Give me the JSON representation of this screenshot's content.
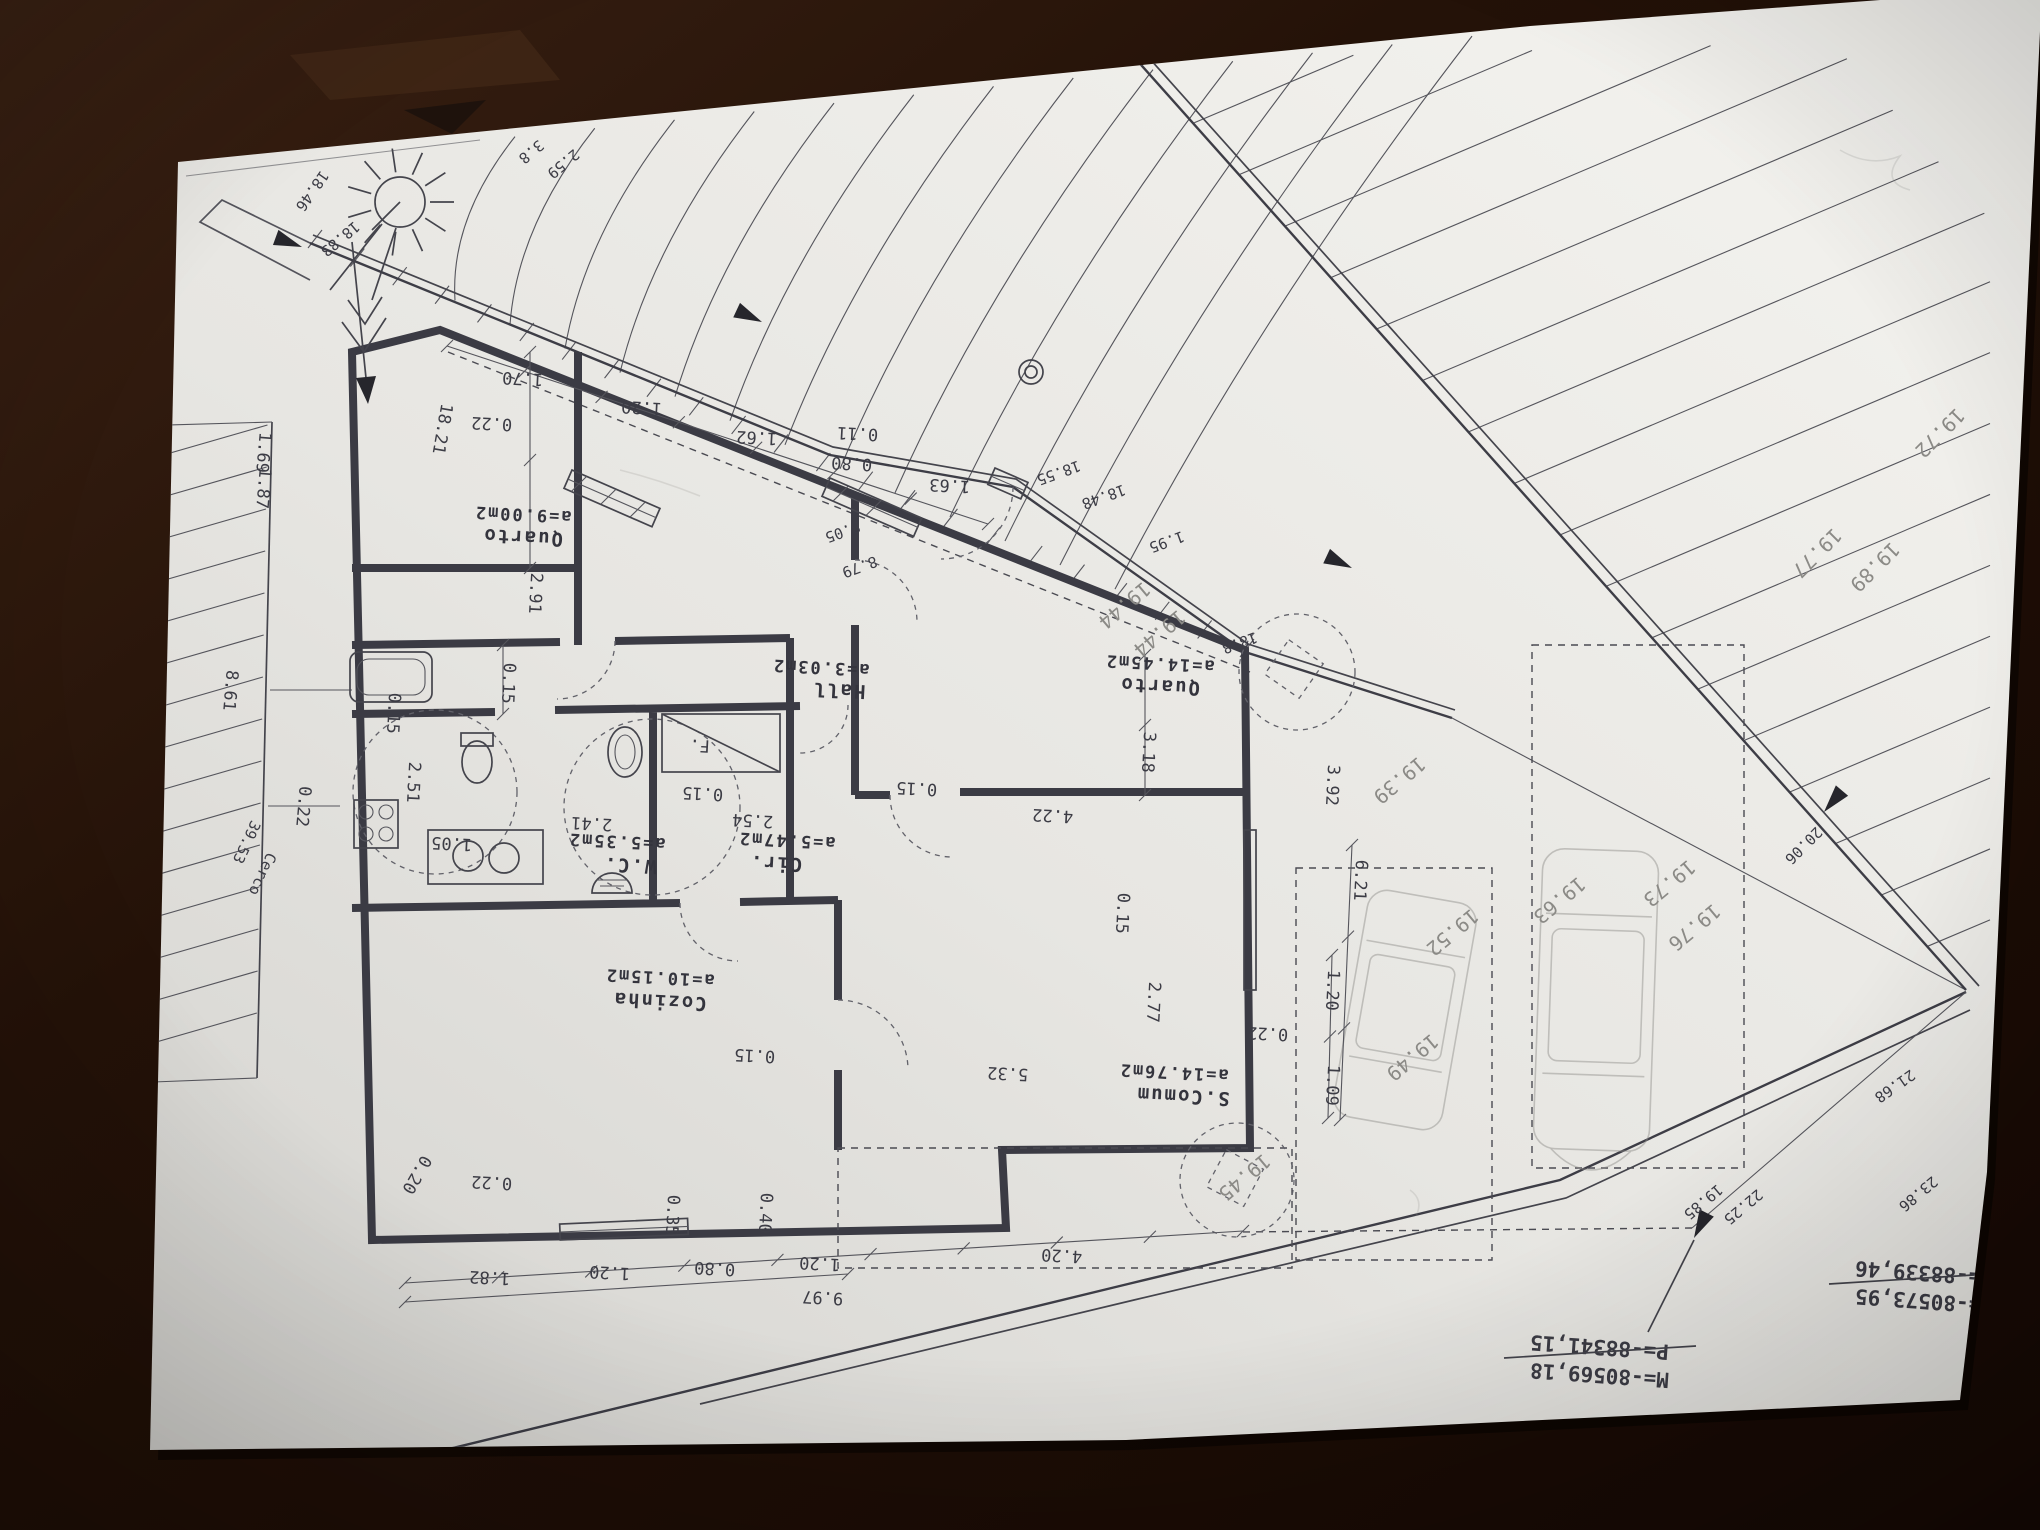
{
  "scene": {
    "description": "Photograph of an architectural site/floor plan sheet lying rotated 180 degrees on a dark wooden table",
    "table_color": "#221308",
    "paper_color": "#e9e8e4",
    "ink_color": "#3c3c45",
    "pencil_color": "#8b8a86"
  },
  "plan": {
    "rooms": [
      {
        "name": "Quarto",
        "area": "a=9.00m2",
        "nx": 523,
        "ny": 531,
        "ax": 523,
        "ay": 509
      },
      {
        "name": "Hall",
        "area": "a=3.03m2",
        "nx": 839,
        "ny": 684,
        "ax": 821,
        "ay": 662
      },
      {
        "name": "Quarto",
        "area": "a=14.45m2",
        "nx": 1160,
        "ny": 680,
        "ax": 1160,
        "ay": 658
      },
      {
        "name": "W.C.",
        "area": "a=5.35m2",
        "nx": 630,
        "ny": 859,
        "ax": 617,
        "ay": 836
      },
      {
        "name": "Cir.",
        "area": "a=5.47m2",
        "nx": 776,
        "ny": 857,
        "ax": 787,
        "ay": 835
      },
      {
        "name": "Cozinha",
        "area": "a=10.15m2",
        "nx": 660,
        "ny": 995,
        "ax": 660,
        "ay": 972
      },
      {
        "name": "S.Comum",
        "area": "a=14.76m2",
        "nx": 1183,
        "ny": 1090,
        "ax": 1174,
        "ay": 1067
      }
    ],
    "dimensions": [
      {
        "t": "1.70",
        "x": 523,
        "y": 373
      },
      {
        "t": "1.20",
        "x": 642,
        "y": 402
      },
      {
        "t": "1.62",
        "x": 757,
        "y": 432
      },
      {
        "t": "0.22",
        "x": 492,
        "y": 418
      },
      {
        "t": "0.11",
        "x": 858,
        "y": 428
      },
      {
        "t": "0.80",
        "x": 852,
        "y": 458
      },
      {
        "t": "1.63",
        "x": 950,
        "y": 480
      },
      {
        "t": "0.15",
        "x": 703,
        "y": 788
      },
      {
        "t": "2.41",
        "x": 592,
        "y": 818
      },
      {
        "t": "2.54",
        "x": 753,
        "y": 815
      },
      {
        "t": "1.05",
        "x": 452,
        "y": 838
      },
      {
        "t": "0.15",
        "x": 917,
        "y": 783
      },
      {
        "t": "4.22",
        "x": 1053,
        "y": 810
      },
      {
        "t": "0.15",
        "x": 755,
        "y": 1050
      },
      {
        "t": "5.32",
        "x": 1008,
        "y": 1068
      },
      {
        "t": "0.22",
        "x": 1268,
        "y": 1028
      },
      {
        "t": "0.22",
        "x": 492,
        "y": 1177
      },
      {
        "t": "1.82",
        "x": 490,
        "y": 1272
      },
      {
        "t": "1.20",
        "x": 610,
        "y": 1267
      },
      {
        "t": "0.80",
        "x": 715,
        "y": 1263
      },
      {
        "t": "1.20",
        "x": 820,
        "y": 1258
      },
      {
        "t": "9.97",
        "x": 823,
        "y": 1292
      },
      {
        "t": "4.20",
        "x": 1062,
        "y": 1250
      },
      {
        "t": "F.",
        "x": 700,
        "y": 740
      },
      {
        "t": "2.91",
        "x": 530,
        "y": 593,
        "r": 93
      },
      {
        "t": "0.15",
        "x": 503,
        "y": 683,
        "r": 93
      },
      {
        "t": "0.15",
        "x": 388,
        "y": 713,
        "r": 93
      },
      {
        "t": "2.51",
        "x": 408,
        "y": 782,
        "r": 93
      },
      {
        "t": "3.18",
        "x": 1143,
        "y": 752,
        "r": 93
      },
      {
        "t": "3.92",
        "x": 1327,
        "y": 785,
        "r": 93
      },
      {
        "t": "6.21",
        "x": 1355,
        "y": 880,
        "r": 93
      },
      {
        "t": "1.20",
        "x": 1327,
        "y": 990,
        "r": 93
      },
      {
        "t": "1.09",
        "x": 1327,
        "y": 1085,
        "r": 93
      },
      {
        "t": "2.77",
        "x": 1148,
        "y": 1002,
        "r": 93
      },
      {
        "t": "0.15",
        "x": 1117,
        "y": 913,
        "r": 93
      },
      {
        "t": "0.35",
        "x": 667,
        "y": 1215,
        "r": 93
      },
      {
        "t": "0.40",
        "x": 760,
        "y": 1213,
        "r": 93
      },
      {
        "t": "8.61",
        "x": 225,
        "y": 690,
        "r": 95
      },
      {
        "t": "0.22",
        "x": 298,
        "y": 806,
        "r": 95
      },
      {
        "t": "1.69",
        "x": 258,
        "y": 452,
        "r": 95
      },
      {
        "t": "1.87",
        "x": 258,
        "y": 488,
        "r": 95
      },
      {
        "t": "18.21",
        "x": 437,
        "y": 428,
        "r": 100
      },
      {
        "t": "0.20",
        "x": 412,
        "y": 1172,
        "r": 120
      }
    ],
    "boundary_labels": [
      {
        "t": "18.83",
        "x": 337,
        "y": 235,
        "r": 140
      },
      {
        "t": "18.46",
        "x": 308,
        "y": 188,
        "r": 125
      },
      {
        "t": "3.8",
        "x": 528,
        "y": 148,
        "r": 140
      },
      {
        "t": "2.59",
        "x": 560,
        "y": 160,
        "r": 140
      },
      {
        "t": "18.55",
        "x": 1057,
        "y": 468,
        "r": 160
      },
      {
        "t": "18.48",
        "x": 1102,
        "y": 492,
        "r": 160
      },
      {
        "t": "8.05",
        "x": 841,
        "y": 527,
        "r": 160
      },
      {
        "t": "8.79",
        "x": 858,
        "y": 562,
        "r": 160
      },
      {
        "t": "1.95",
        "x": 1165,
        "y": 537,
        "r": 160
      },
      {
        "t": "18.8",
        "x": 1238,
        "y": 638,
        "r": 160
      },
      {
        "t": "20.06",
        "x": 1800,
        "y": 842,
        "r": 135
      },
      {
        "t": "21.68",
        "x": 1892,
        "y": 1082,
        "r": 145
      },
      {
        "t": "19.85",
        "x": 1700,
        "y": 1198,
        "r": 140
      },
      {
        "t": "22.25",
        "x": 1740,
        "y": 1203,
        "r": 140
      },
      {
        "t": "23.86",
        "x": 1915,
        "y": 1190,
        "r": 140
      },
      {
        "t": "39.53",
        "x": 242,
        "y": 840,
        "r": 115
      },
      {
        "t": "Cerco",
        "x": 258,
        "y": 872,
        "r": 115
      }
    ],
    "survey_levels_pencil": [
      {
        "t": "19.44",
        "x": 1120,
        "y": 600
      },
      {
        "t": "19.44",
        "x": 1155,
        "y": 628
      },
      {
        "t": "19.39",
        "x": 1395,
        "y": 775
      },
      {
        "t": "19.52",
        "x": 1448,
        "y": 927
      },
      {
        "t": "19.49",
        "x": 1408,
        "y": 1052
      },
      {
        "t": "19.63",
        "x": 1555,
        "y": 895
      },
      {
        "t": "19.73",
        "x": 1665,
        "y": 878
      },
      {
        "t": "19.76",
        "x": 1690,
        "y": 922
      },
      {
        "t": "19.45",
        "x": 1240,
        "y": 1172
      },
      {
        "t": "19.72",
        "x": 1935,
        "y": 428,
        "r": 135
      },
      {
        "t": "19.77",
        "x": 1812,
        "y": 548,
        "r": 135
      },
      {
        "t": "19.89",
        "x": 1870,
        "y": 562,
        "r": 135
      }
    ],
    "coordinate_blocks": [
      {
        "m": "M=-80573,95",
        "p": "P=-88339,46",
        "x": 1925,
        "y": 1278
      },
      {
        "m": "M=-80569,18",
        "p": "P=-88341,15",
        "x": 1600,
        "y": 1352
      }
    ],
    "icons": {
      "sun": "sun-icon",
      "north_arrow": "north-arrow-icon",
      "trees": "tree-icon",
      "cars": "pencil-car-sketch",
      "gate": "gate-symbol"
    }
  }
}
